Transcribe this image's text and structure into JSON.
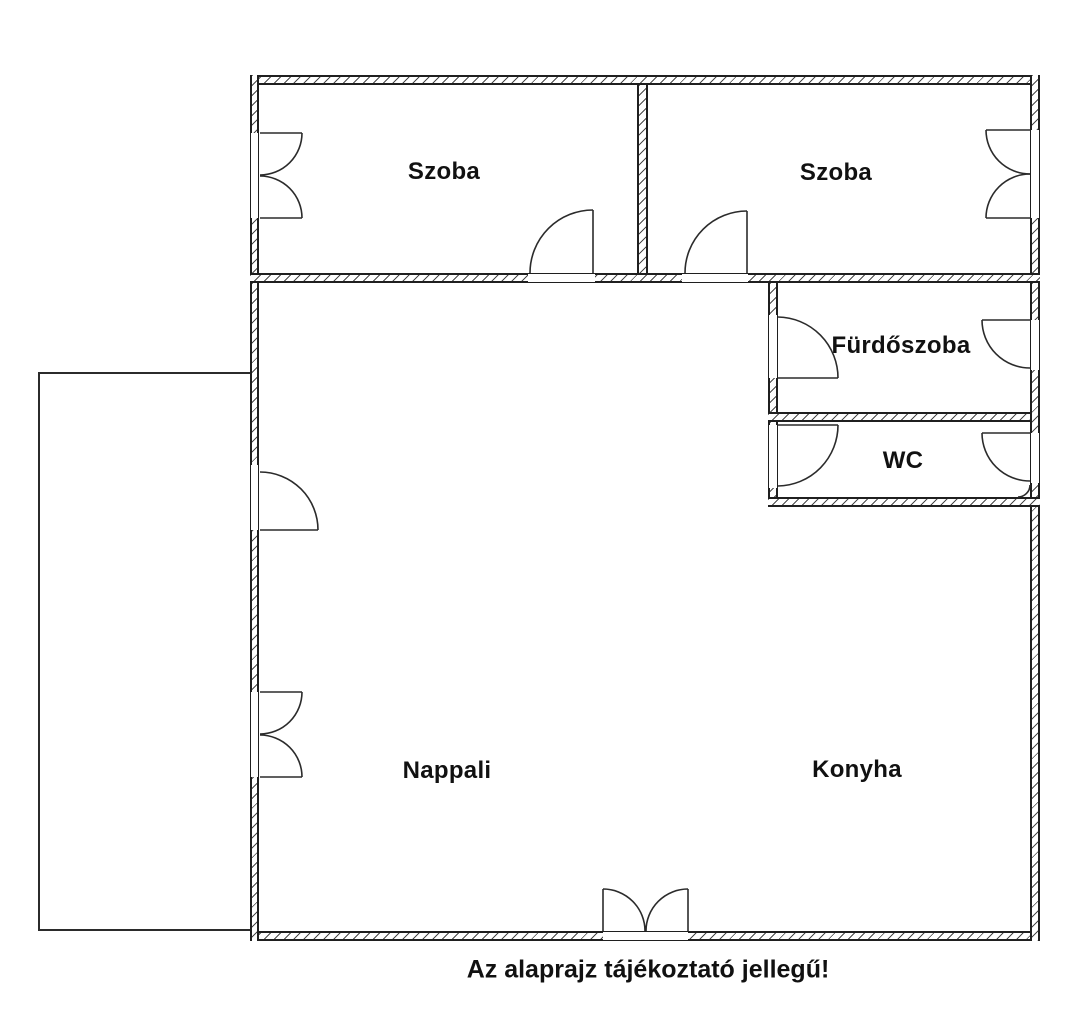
{
  "caption": "Az alaprajz tájékoztató jellegű!",
  "rooms": [
    {
      "id": "bedroom-1",
      "label": "Szoba"
    },
    {
      "id": "bedroom-2",
      "label": "Szoba"
    },
    {
      "id": "bathroom",
      "label": "Fürdőszoba"
    },
    {
      "id": "wc",
      "label": "WC"
    },
    {
      "id": "living-room",
      "label": "Nappali"
    },
    {
      "id": "kitchen",
      "label": "Konyha"
    }
  ],
  "colors": {
    "background": "#ffffff",
    "wall_outline": "#1f1f1f",
    "wall_hatch": "#4a4a4a",
    "text": "#111111"
  }
}
